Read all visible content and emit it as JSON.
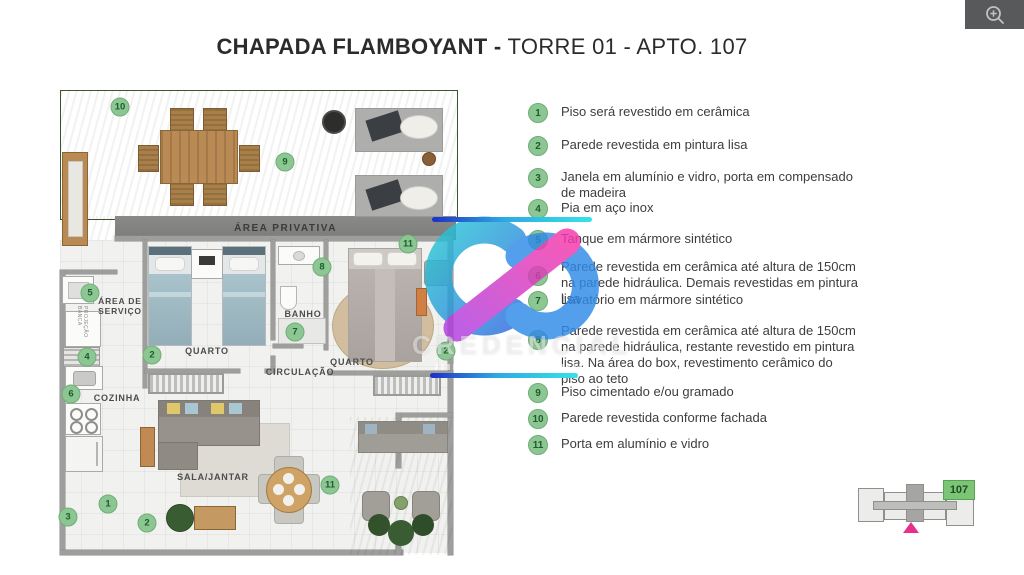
{
  "title": {
    "bold": "CHAPADA FLAMBOYANT -",
    "regular": " TORRE 01 - APTO. 107"
  },
  "toolbar": {
    "zoom_icon": "magnifier-plus-icon"
  },
  "legend": {
    "items": [
      {
        "num": "1",
        "y": 103,
        "co": 0,
        "text": "Piso será revestido em cerâmica"
      },
      {
        "num": "2",
        "y": 136,
        "co": 0,
        "text": "Parede revestida em pintura lisa"
      },
      {
        "num": "3",
        "y": 168,
        "co": 0,
        "text": "Janela em alumínio e vidro, porta em compensado de madeira"
      },
      {
        "num": "4",
        "y": 199,
        "co": 0,
        "text": "Pia em aço inox"
      },
      {
        "num": "5",
        "y": 230,
        "co": 0,
        "text": "Tanque em mármore sintético"
      },
      {
        "num": "6",
        "y": 258,
        "co": 8,
        "text": "Parede revestida em cerâmica até altura de 150cm na parede hidráulica. Demais revestidas em pintura lisa"
      },
      {
        "num": "7",
        "y": 291,
        "co": 0,
        "text": "Lavatório em mármore sintético"
      },
      {
        "num": "8",
        "y": 322,
        "co": 8,
        "text": "Parede revestida em cerâmica até altura de 150cm na parede hidráulica, restante revestido em pintura lisa. Na área do box, revestimento cerâmico do piso ao teto"
      },
      {
        "num": "9",
        "y": 383,
        "co": 0,
        "text": "Piso cimentado e/ou gramado"
      },
      {
        "num": "10",
        "y": 409,
        "co": 0,
        "text": "Parede revestida conforme fachada"
      },
      {
        "num": "11",
        "y": 435,
        "co": 0,
        "text": "Porta em alumínio e vidro"
      }
    ]
  },
  "plan": {
    "labels": {
      "area_privativa": "ÁREA PRIVATIVA",
      "area_servico": "ÁREA DE\nSERVIÇO",
      "quarto": "QUARTO",
      "banho": "BANHO",
      "circulacao": "CIRCULAÇÃO",
      "cozinha": "COZINHA",
      "sala_jantar": "SALA/JANTAR",
      "projecao": "PROJEÇÃO BANCA"
    },
    "markers": [
      {
        "n": "10",
        "x": 60,
        "y": 19
      },
      {
        "n": "9",
        "x": 225,
        "y": 74
      },
      {
        "n": "11",
        "x": 348,
        "y": 156
      },
      {
        "n": "8",
        "x": 262,
        "y": 179
      },
      {
        "n": "5",
        "x": 30,
        "y": 205
      },
      {
        "n": "7",
        "x": 235,
        "y": 244
      },
      {
        "n": "4",
        "x": 27,
        "y": 269
      },
      {
        "n": "2",
        "x": 92,
        "y": 267
      },
      {
        "n": "2",
        "x": 386,
        "y": 263
      },
      {
        "n": "6",
        "x": 11,
        "y": 306
      },
      {
        "n": "1",
        "x": 48,
        "y": 416
      },
      {
        "n": "11",
        "x": 270,
        "y": 397
      },
      {
        "n": "3",
        "x": 8,
        "y": 429
      },
      {
        "n": "2",
        "x": 87,
        "y": 435
      }
    ]
  },
  "watermark": {
    "text": "CREDENCIAL"
  },
  "keyplan": {
    "unit": "107"
  },
  "colors": {
    "marker_green": "#8cc693",
    "grass_green": "#4c6a3a",
    "band_gray": "#828280",
    "accent_pink": "#e8308a",
    "unit_green": "#7cc576",
    "logo_teal": "#27b9d6",
    "logo_blue": "#2f7fe8",
    "logo_pink": "#e83db8",
    "line_gradient_start": "#1f2fc6",
    "line_gradient_end": "#35e3ea"
  }
}
